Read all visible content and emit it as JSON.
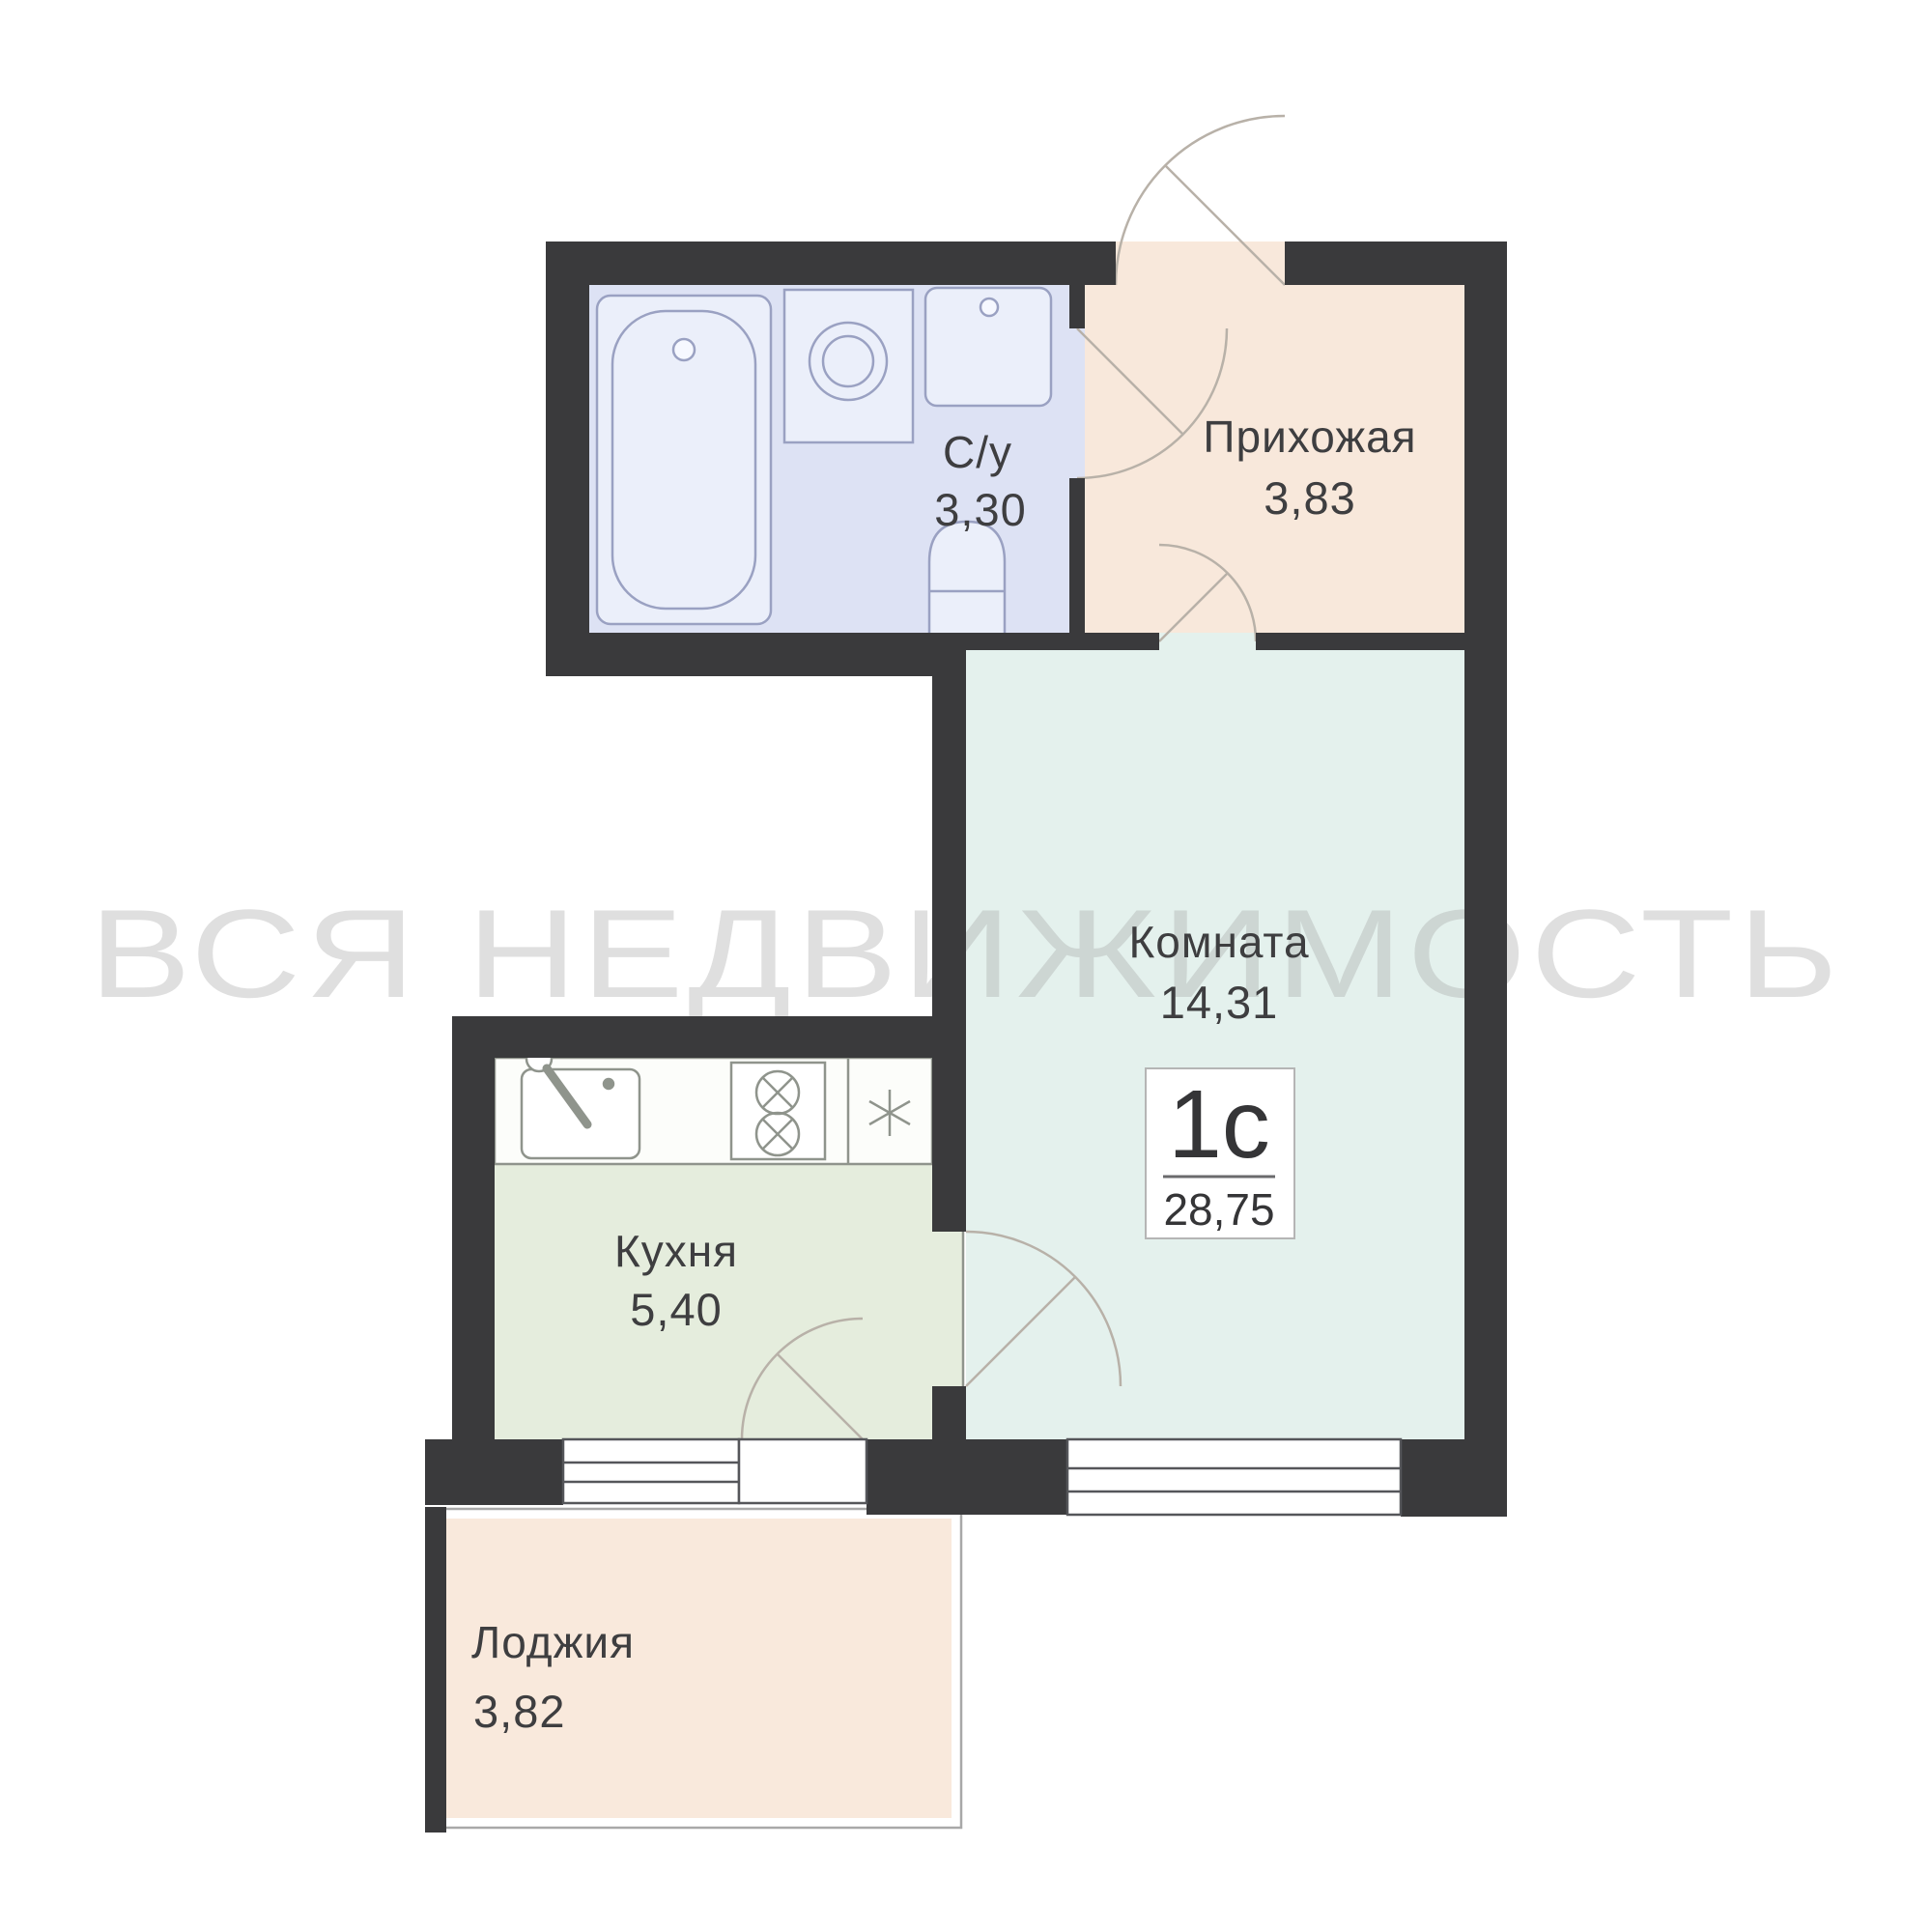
{
  "watermark": {
    "text": "ВСЯ НЕДВИЖИМОСТЬ",
    "color": "#9e9e9e"
  },
  "badge": {
    "type_label": "1с",
    "total_area": "28,75",
    "border_color": "#b5b5b5",
    "text_color": "#353537"
  },
  "rooms": [
    {
      "name": "bathroom",
      "label": "С/у",
      "area": "3,30",
      "fill": "#dde2f4"
    },
    {
      "name": "hallway",
      "label": "Прихожая",
      "area": "3,83",
      "fill": "#f8e8db"
    },
    {
      "name": "room",
      "label": "Комната",
      "area": "14,31",
      "fill": "#e4f1ed"
    },
    {
      "name": "kitchen",
      "label": "Кухня",
      "area": "5,40",
      "fill": "#e5eddd"
    },
    {
      "name": "loggia",
      "label": "Лоджия",
      "area": "3,82",
      "fill": "#f9e9dc"
    }
  ],
  "colors": {
    "wall": "#3a3a3c",
    "label": "#3e3e40",
    "door_arc": "#b8b1a8",
    "window": "#55565a",
    "bath_fixture": "#9aa1c2",
    "bath_fixture_fill": "#ebeffa",
    "kitchen_fixture": "#8f948c",
    "counter_fill": "#fcfdfa",
    "loggia_frame": "#a8a8a8"
  }
}
